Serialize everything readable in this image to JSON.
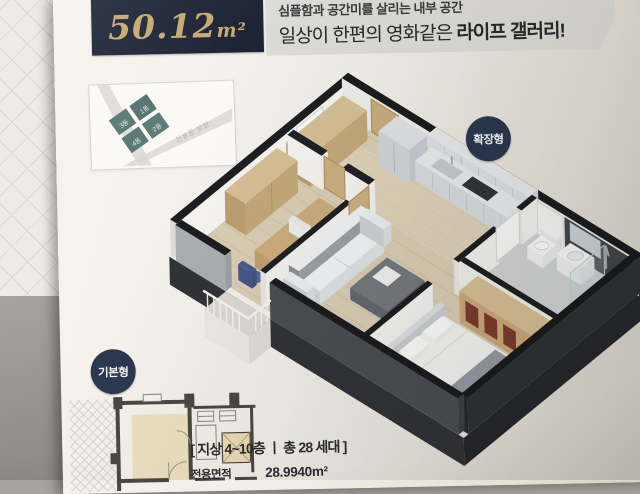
{
  "page": {
    "corner_mark": "18",
    "area_box": {
      "value": "50.12",
      "unit": "m²"
    },
    "headline": {
      "line1": "심플함과 공간미를 살리는 내부 공간",
      "line2_prefix": "일상이 한편의 영화같은 ",
      "line2_bold": "라이프 갤러리!"
    },
    "badges": {
      "expanded": "확장형",
      "basic": "기본형"
    },
    "sitemap": {
      "road_label": "신봉동 방향",
      "blocks": [
        "3동",
        "1동",
        "4동",
        "2동"
      ]
    },
    "info": {
      "floors_line": "[ 지상 4~10층 ㅣ 총 28 세대 ]",
      "area_label": "전용면적",
      "area_value": "28.9940m²"
    }
  },
  "colors": {
    "accent_navy": "#2c3850",
    "gold_text": "#c8ab72",
    "banner_gray": "#dedcd6",
    "block_teal": "#5d7a78",
    "wall_cap_black": "#1b1c1e",
    "floor_wood": "#dacdb4",
    "page_paper": "#f2efe9"
  }
}
